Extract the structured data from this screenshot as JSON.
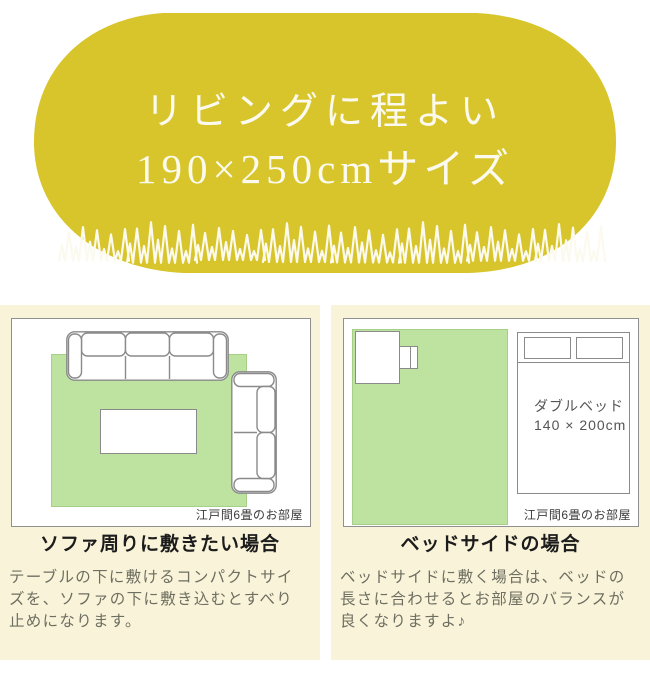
{
  "hero": {
    "line1": "リビングに程よい",
    "line2": "190×250cmサイズ"
  },
  "sofa_section": {
    "room_label": "江戸間6畳のお部屋",
    "heading": "ソファ周りに敷きたい場合",
    "description": "テーブルの下に敷けるコンパクトサイ\nズを、ソファの下に敷き込むとすべり\n止めになります。"
  },
  "bed_section": {
    "room_label": "江戸間6畳のお部屋",
    "heading": "ベッドサイドの場合",
    "description": "ベッドサイドに敷く場合は、ベッドの\n長さに合わせるとお部屋のバランスが\n良くなりますよ♪",
    "bed_label_line1": "ダブルベッド",
    "bed_label_line2": "140 × 200cm"
  },
  "colors": {
    "hero_bg": "#d7c52b",
    "hero_text": "#fcfaef",
    "panel_bg": "#f9f4d9",
    "rug": "#bee3a1",
    "rug_border": "#a6cf87",
    "outline": "#8a8a8a"
  }
}
